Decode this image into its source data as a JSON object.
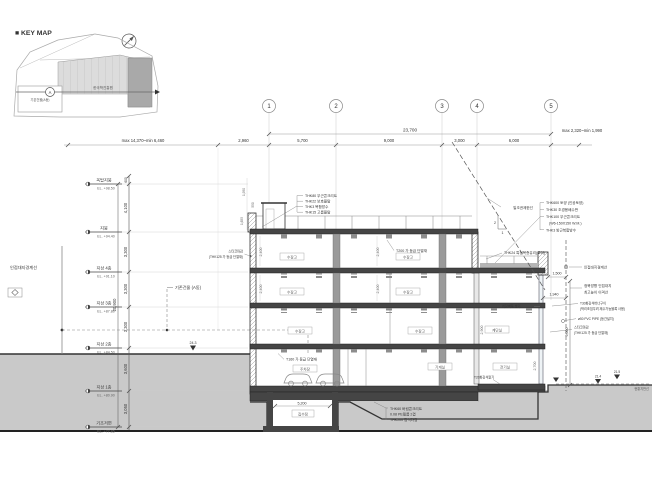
{
  "key_map": {
    "title": "■ KEY MAP",
    "site_label": "한국학진흥원",
    "existing_label": "기존건물(A동)",
    "section_mark": "A"
  },
  "grid_bubbles": [
    "1",
    "2",
    "3",
    "4",
    "5"
  ],
  "dims_top": {
    "total": "23,700",
    "left_range": "max 14,370~min 6,460",
    "right_range": "max 2,320~min 1,990",
    "segments": [
      "2,960",
      "5,700",
      "9,000",
      "3,000",
      "6,000"
    ]
  },
  "levels": [
    {
      "name": "옥탑지붕",
      "el": "EL. +98.50"
    },
    {
      "name": "지붕",
      "el": "EL. +94.40"
    },
    {
      "name": "지상 4층",
      "el": "EL. +91.10"
    },
    {
      "name": "지상 3층",
      "el": "EL. +87.80"
    },
    {
      "name": "지상 2층",
      "el": "EL. +84.50"
    },
    {
      "name": "지상 1층",
      "el": "EL. +80.90"
    },
    {
      "name": "기초저면",
      "el": "EL. +77.85"
    }
  ],
  "v_dims": {
    "items": [
      "4,100",
      "3,300",
      "3,300",
      "3,300",
      "3,600",
      "3,050"
    ],
    "total": "20,900",
    "top": "600"
  },
  "site": {
    "left_boundary": "인접대지경계선",
    "existing_building": "기존건물 (A동)",
    "ground_left": "24.3",
    "ground_right_a": "21.4",
    "ground_right_b": "21.5",
    "grade_label": "현황지반선"
  },
  "notes_roof_left": [
    "THK80 무근콘크리트",
    "THK22 보호몰탈",
    "THK3 복합방수",
    "THK15 고름몰탈"
  ],
  "notes_roof_right": [
    "THK600 토양 (인공토양)",
    "THK30 조경용배수판",
    "THK100 무근콘크리트",
    "(W6-150X150 W.M.)",
    "THK3 방근복합방수"
  ],
  "sun": {
    "label": "일조권제한선",
    "ratio_v": "2",
    "ratio_h": "1"
  },
  "right_notes": {
    "glass": "THK24 특청복층유리(로이)",
    "boundary": "인접대지경계선",
    "dim_a": "1,500",
    "setback1": "정북방향 인접대지",
    "setback2": "최고높이 이격선",
    "dim_b": "1,940",
    "stone1": "T30화강석버너구이",
    "stone2": "(박리조짐우려 제수가능블록 사용)",
    "pipe": "ø50 PVC PIPE (등간설치)",
    "stucco1": "스타코마감",
    "stucco2": "(THK125 가 등급 단열재)",
    "brick": "치장벽돌 쌓기",
    "paving": "T20화강석깔기",
    "dim_v": "9,000"
  },
  "left_wall_note": {
    "l1": "스타코마감",
    "l2": "(THK125 가 등급 단열재)"
  },
  "insulation": {
    "roof": "T200 가 등급 단열재",
    "parking": "T160 가 등급 단열재"
  },
  "foundation_notes": [
    "THK60 버림콘크리트",
    "0.08 PE필름 2겹",
    "THK200 잡석다짐"
  ],
  "pit": {
    "dim": "5,200",
    "label": "집수정"
  },
  "rooms": [
    "수장고",
    "수장고",
    "수장고",
    "수장고",
    "수장고",
    "수장고",
    "계단실",
    "기계실",
    "전기실"
  ],
  "parking_label": "주차장",
  "interior_dims": {
    "a": "2,400",
    "b": "2,400",
    "c": "2,400",
    "d": "2,400",
    "e": "2,900",
    "f": "2,700"
  },
  "penthouse_dims": {
    "a": "1,950",
    "b": "550",
    "c": "1,655"
  }
}
